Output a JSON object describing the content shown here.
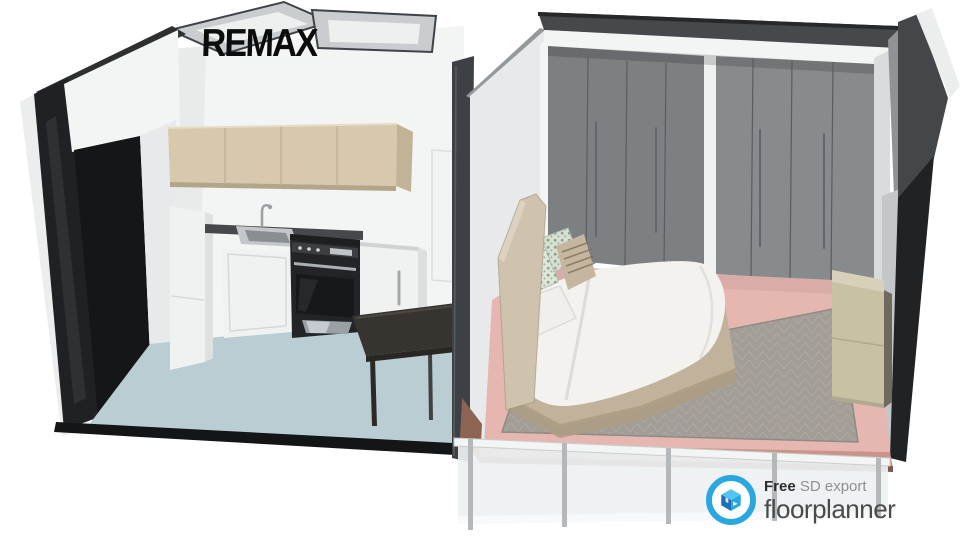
{
  "watermark": {
    "brand": "REMAX"
  },
  "footer_logo": {
    "free_label": "Free",
    "export_label": " SD export",
    "brand": "floorplanner",
    "icon": "floorplanner-cube-icon"
  },
  "scene": {
    "type": "3d-floorplan-cutaway-render",
    "rooms": [
      {
        "name": "kitchen",
        "floor_color": "#b9cdd3",
        "items": [
          "refrigerator",
          "wall-cabinets",
          "countertop",
          "kitchen-sink",
          "faucet",
          "sink-base-cabinet",
          "stove-oven",
          "washing-machine",
          "dining-table",
          "doorway"
        ]
      },
      {
        "name": "bedroom",
        "floor_color": "#e6b6b0",
        "items": [
          "double-bed",
          "headboard",
          "pillows",
          "duvet",
          "wardrobe-left-unit",
          "wardrobe-right-unit",
          "area-rug",
          "dresser"
        ]
      },
      {
        "name": "balcony",
        "items": [
          "glass-railing",
          "railing-posts",
          "top-rail"
        ]
      },
      {
        "name": "utility-rooms-top",
        "items": [
          "small-room-left",
          "small-room-right"
        ]
      }
    ]
  },
  "colors": {
    "bg": "#ffffff",
    "text_dark": "#0c0c0c",
    "wall_white": "#f3f4f4",
    "wall_shade": "#e7e9ea",
    "wall_cut_dark": "#2d2f31",
    "wall_cut_mid": "#95999c",
    "wall_cut_light": "#c9cdcf",
    "room_interior": "#eef0f0",
    "outer_sliver": "#eceeee",
    "doorway_black": "#151618",
    "kitchen_floor": "#b9cdd3",
    "floor_edge_dark": "#141517",
    "cabinet_beige": "#d8c9ad",
    "cabinet_beige_shade": "#c2b296",
    "counter_dark": "#46494c",
    "steel": "#aab0b4",
    "appliance_white": "#f0f1f1",
    "stove_black": "#232427",
    "table_dark": "#37332f",
    "wardrobe_gray": "#7d8082",
    "wardrobe_gray_light": "#888b8d",
    "wardrobe_seam": "#5a5d60",
    "bedroom_floor": "#e6b6b0",
    "slab_edge_pink": "#c9958a",
    "rug_gray": "#a29e97",
    "dresser_khaki": "#c8c1a4",
    "dresser_top": "#d7d1b9",
    "bed_taupe": "#c1b29b",
    "headboard_taupe": "#cfc3ad",
    "duvet_white": "#f3f2ef",
    "railing_glass": "#eef1f2",
    "railing_post": "#b4b8ba",
    "railing_rail": "#f3f5f5",
    "logo_blue": "#2aa7de",
    "logo_blue_dark": "#1c6fb8",
    "logo_blue_light": "#55c3f0",
    "brand_gray": "#4a4a4a",
    "muted_gray": "#8f8f8f",
    "tag_dark": "#2d2d2d"
  }
}
